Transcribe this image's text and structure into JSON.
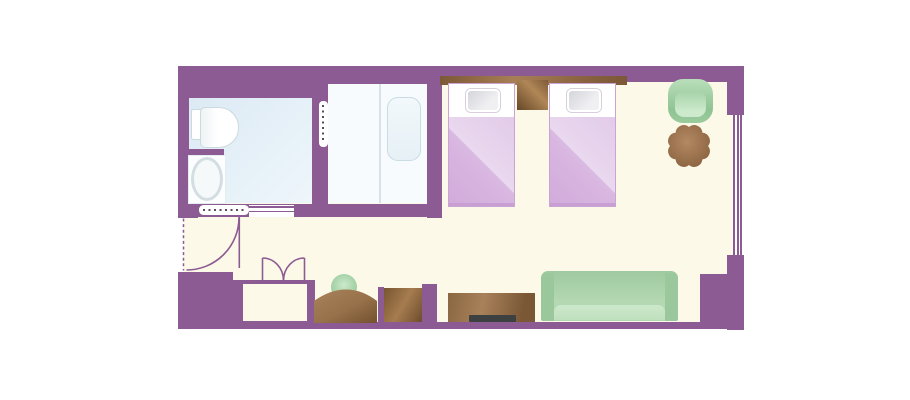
{
  "scene": "hotel-guestroom-floor-plan",
  "palette": {
    "wall": "#8c5b93",
    "floor": "#fdf9e8",
    "bath-floor-1": "#dceaf4",
    "bath-floor-2": "#eef6fb",
    "tubroom-floor": "#f7fbfd",
    "divider": "#d7e3ea",
    "fixture-border": "#ccd9df",
    "tub-border": "#c9dbe3",
    "bed-cover-1": "#e9d8ee",
    "bed-cover-2": "#d2abdb",
    "bed-border": "#cba3d4",
    "bed-foot": "#c79fd2",
    "pillow-1": "#f0f0f3",
    "pillow-2": "#d4d5da",
    "wood-dark": "#744f2e",
    "wood-mid": "#9a714a",
    "wood-light": "#b08756",
    "tv": "#3c4040",
    "green-dark": "#9ac79b",
    "green-light": "#cde9cc",
    "door-mark": "#5e4a5c"
  },
  "regions": [
    "bathroom-toilet-sink",
    "shower-tub-room",
    "entry-corridor",
    "bedroom"
  ],
  "fixtures": [
    "toilet",
    "washbasin-counter",
    "bathtub",
    "shower-partition",
    "accordion-door-horizontal",
    "sliding-door-track",
    "accordion-door-vertical",
    "entry-door-swing",
    "closet-double-doors",
    "headboard",
    "nightstand",
    "twin-bed-left",
    "twin-bed-right",
    "armchair",
    "round-side-table",
    "dressing-desk",
    "stool",
    "cabinet",
    "tv-board",
    "tv",
    "sofa",
    "window"
  ]
}
